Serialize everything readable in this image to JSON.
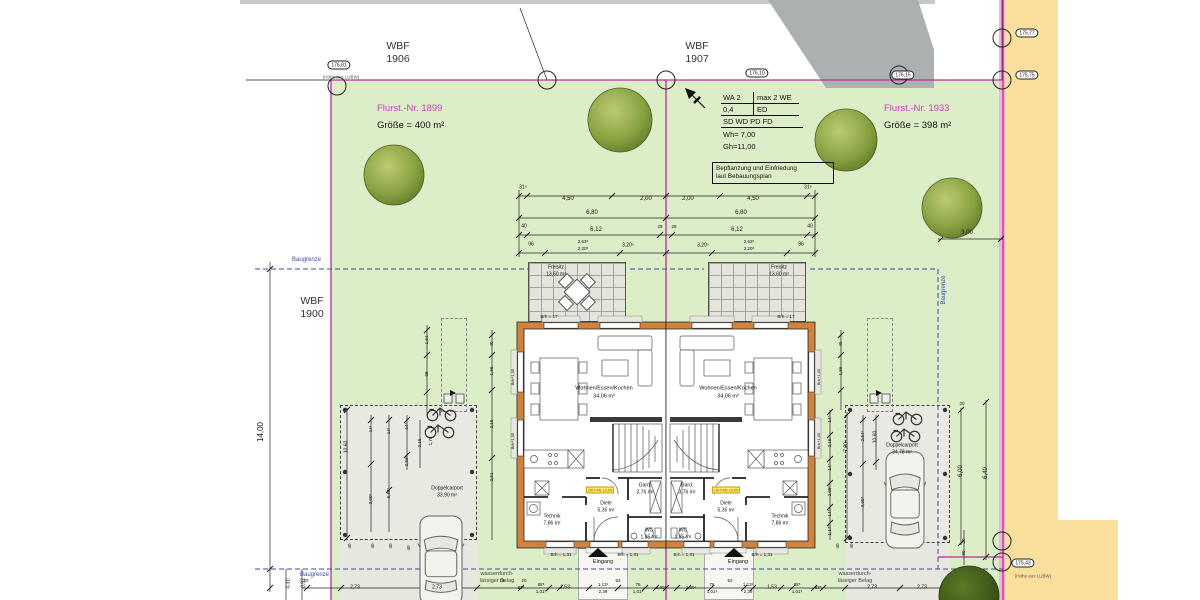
{
  "labels": {
    "wbf_1906": {
      "l1": "WBF",
      "l2": "1906"
    },
    "wbf_1907": {
      "l1": "WBF",
      "l2": "1907"
    },
    "wbf_1900": {
      "l1": "WBF",
      "l2": "1900"
    }
  },
  "parcels": {
    "left": {
      "nr": "Flurst.-Nr. 1899",
      "size": "Größe = 400 m²"
    },
    "right": {
      "nr": "Flurst.-Nr. 1933",
      "size": "Größe = 398 m²"
    }
  },
  "zoning": {
    "r1c1": "WA 2",
    "r1c2": "max 2 WE",
    "r2c1": "0,4",
    "r2c2": "ED",
    "r3": "SD WD PD FD",
    "wh": "Wh= 7,00",
    "gh": "Gh=11,00",
    "note1": "Bepflanzung und Einfriedung",
    "note2": "laut Bebauungsplan"
  },
  "baugrenze": {
    "label": "Baugrenze"
  },
  "paving": {
    "line1": "wasserdurch-",
    "line2": "lässiger Belag"
  },
  "entrance": {
    "label": "Eingang"
  },
  "floor_tag": "OK FFB ±0,00",
  "floor_tags": [
    [
      600,
      490
    ],
    [
      726,
      490
    ]
  ],
  "ovals": [
    [
      339,
      65,
      "176,81"
    ],
    [
      757,
      73,
      "176,10"
    ],
    [
      903,
      75,
      "176,15"
    ],
    [
      1027,
      33,
      "175,77"
    ],
    [
      1027,
      75,
      "175,75"
    ],
    [
      1023,
      563,
      "175,43"
    ]
  ],
  "oval_subs": [
    [
      341,
      77,
      "(Höhe aus LUBW)"
    ],
    [
      1033,
      576,
      "(Höhe aus LUBW)"
    ]
  ],
  "survey_circles": [
    [
      337,
      86
    ],
    [
      547,
      80
    ],
    [
      666,
      80
    ],
    [
      899,
      75
    ],
    [
      1002,
      38
    ],
    [
      1002,
      80
    ],
    [
      1002,
      541
    ],
    [
      1002,
      562
    ]
  ],
  "trees": [
    [
      394,
      175,
      30,
      0
    ],
    [
      620,
      120,
      32,
      0
    ],
    [
      846,
      140,
      31,
      0
    ],
    [
      952,
      208,
      30,
      0
    ],
    [
      969,
      596,
      30,
      1
    ]
  ],
  "colors": {
    "boundary": "#c02aa0",
    "baugrenze": "#3d49a6",
    "lawn": "#dceec7",
    "street": "#fbdf9d",
    "wall": "#d0833e",
    "flurst_text": "#cc3fc0"
  },
  "annotations": [
    [
      523,
      188,
      "31⁵",
      0,
      5
    ],
    [
      808,
      188,
      "31⁵",
      0,
      5
    ],
    [
      568,
      199,
      "4,50",
      0,
      0
    ],
    [
      646,
      199,
      "2,00",
      0,
      0
    ],
    [
      688,
      199,
      "2,00",
      0,
      0
    ],
    [
      753,
      199,
      "4,50",
      0,
      0
    ],
    [
      592,
      213,
      "6,80",
      0,
      0
    ],
    [
      741,
      213,
      "6,80",
      0,
      0
    ],
    [
      524,
      227,
      "40",
      0,
      5
    ],
    [
      810,
      227,
      "40",
      0,
      5
    ],
    [
      596,
      230,
      "6,12",
      0,
      0
    ],
    [
      737,
      230,
      "6,12",
      0,
      0
    ],
    [
      660,
      227,
      "28",
      0,
      4.5
    ],
    [
      674,
      227,
      "28",
      0,
      4.5
    ],
    [
      531,
      245,
      "96",
      0,
      5
    ],
    [
      801,
      245,
      "96",
      0,
      5
    ],
    [
      583,
      242,
      "2,63⁵",
      0,
      4.5
    ],
    [
      583,
      249,
      "2,20⁵",
      0,
      4.5
    ],
    [
      749,
      242,
      "2,63⁵",
      0,
      4.5
    ],
    [
      749,
      249,
      "2,20⁵",
      0,
      4.5
    ],
    [
      628,
      246,
      "3,20⁵",
      0,
      5
    ],
    [
      703,
      246,
      "3,20⁵",
      0,
      5
    ],
    [
      261,
      432,
      "14,00",
      1,
      8
    ],
    [
      289,
      583,
      "4,31¹",
      1,
      5
    ],
    [
      304,
      583,
      "3,92",
      1,
      5
    ],
    [
      967,
      233,
      "3,00",
      0,
      0
    ],
    [
      961,
      471,
      "6,00",
      1,
      6
    ],
    [
      986,
      473,
      "6,40",
      1,
      6
    ],
    [
      962,
      404,
      "20",
      0,
      4.5
    ],
    [
      964,
      541,
      "20",
      1,
      4.5
    ],
    [
      964,
      553,
      "80",
      1,
      4.5
    ],
    [
      347,
      447,
      "10,60",
      1,
      5
    ],
    [
      371,
      429,
      "14¹",
      1,
      4.5
    ],
    [
      371,
      499,
      "3,00⁵",
      1,
      4.5
    ],
    [
      389,
      431,
      "14¹",
      1,
      4.5
    ],
    [
      389,
      493,
      "5,69⁵",
      1,
      4.5
    ],
    [
      407,
      426,
      "14⁵",
      1,
      4.5
    ],
    [
      407,
      461,
      "2,56⁵",
      1,
      4.5
    ],
    [
      420,
      443,
      "2,15",
      1,
      4.5
    ],
    [
      431,
      441,
      "1,78",
      1,
      4.5
    ],
    [
      350,
      546,
      "40",
      1,
      4.5
    ],
    [
      373,
      546,
      "40",
      1,
      4.5
    ],
    [
      391,
      546,
      "40",
      1,
      4.5
    ],
    [
      409,
      548,
      "40",
      1,
      4.5
    ],
    [
      447,
      489,
      "Doppelcarport",
      0,
      5
    ],
    [
      447,
      496,
      "33,90 m²",
      0,
      5
    ],
    [
      830,
      419,
      "14⁵",
      1,
      4.5
    ],
    [
      830,
      443,
      "2,15",
      1,
      4.5
    ],
    [
      830,
      467,
      "14⁵",
      1,
      4.5
    ],
    [
      830,
      491,
      "2,08⁵",
      1,
      4.5
    ],
    [
      830,
      513,
      "14⁵",
      1,
      4.5
    ],
    [
      830,
      530,
      "1,17⁵",
      1,
      4.5
    ],
    [
      847,
      447,
      "7,20",
      1,
      5
    ],
    [
      863,
      436,
      "2,54⁵",
      1,
      4.5
    ],
    [
      863,
      502,
      "3,00⁵",
      1,
      4.5
    ],
    [
      876,
      437,
      "10,60",
      1,
      5
    ],
    [
      838,
      546,
      "40",
      1,
      4.5
    ],
    [
      852,
      546,
      "40",
      1,
      4.5
    ],
    [
      902,
      446,
      "Doppelcarport",
      0,
      5
    ],
    [
      902,
      453,
      "34,78 m²",
      0,
      5
    ],
    [
      427,
      340,
      "1,64",
      1,
      4.5
    ],
    [
      427,
      374,
      "98",
      1,
      4.5
    ],
    [
      492,
      344,
      "40",
      1,
      4.5
    ],
    [
      492,
      371,
      "1,86",
      1,
      4.5
    ],
    [
      492,
      424,
      "2,15",
      1,
      4.5
    ],
    [
      492,
      477,
      "2,51",
      1,
      4.5
    ],
    [
      841,
      344,
      "40",
      1,
      4.5
    ],
    [
      841,
      371,
      "1,86",
      1,
      4.5
    ],
    [
      556,
      268,
      "Freisitz",
      0,
      5
    ],
    [
      556,
      275,
      "13,60 m²",
      0,
      5
    ],
    [
      779,
      268,
      "Freisitz",
      0,
      5
    ],
    [
      779,
      275,
      "13,60 m²",
      0,
      5
    ],
    [
      549,
      317,
      "Brh = 17",
      0,
      4.5
    ],
    [
      786,
      317,
      "Brh = 17",
      0,
      4.5
    ],
    [
      604,
      389,
      "Wohnen/Essen/Kochen",
      0,
      5.5
    ],
    [
      604,
      397,
      "34,06 m²",
      0,
      5.5
    ],
    [
      728,
      389,
      "Wohnen/Essen/Kochen",
      0,
      5.5
    ],
    [
      728,
      397,
      "34,06 m²",
      0,
      5.5
    ],
    [
      645,
      486,
      "Gard.",
      0,
      5
    ],
    [
      645,
      493,
      "3,76 m²",
      0,
      5
    ],
    [
      687,
      486,
      "Gard.",
      0,
      5
    ],
    [
      687,
      493,
      "3,76 m²",
      0,
      5
    ],
    [
      606,
      504,
      "Diele",
      0,
      5
    ],
    [
      606,
      511,
      "5,35 m²",
      0,
      5
    ],
    [
      726,
      504,
      "Diele",
      0,
      5
    ],
    [
      726,
      511,
      "5,35 m²",
      0,
      5
    ],
    [
      552,
      517,
      "Technik",
      0,
      5
    ],
    [
      552,
      524,
      "7,86 m²",
      0,
      5
    ],
    [
      780,
      517,
      "Technik",
      0,
      5
    ],
    [
      780,
      524,
      "7,86 m²",
      0,
      5
    ],
    [
      649,
      531,
      "WC",
      0,
      5
    ],
    [
      649,
      538,
      "1,85 m²",
      0,
      5
    ],
    [
      683,
      531,
      "WC",
      0,
      5
    ],
    [
      683,
      538,
      "1,85 m²",
      0,
      5
    ],
    [
      513,
      377,
      "Brh+1,05",
      1,
      4
    ],
    [
      513,
      441,
      "Brh+1,05",
      1,
      4
    ],
    [
      819,
      377,
      "Brh+1,05",
      1,
      4
    ],
    [
      819,
      441,
      "Brh+1,05",
      1,
      4
    ],
    [
      561,
      555,
      "Brh = 1,31",
      0,
      4.5
    ],
    [
      628,
      555,
      "Brh = 1,31",
      0,
      4.5
    ],
    [
      684,
      555,
      "Brh = 1,31",
      0,
      4.5
    ],
    [
      762,
      555,
      "Brh = 1,31",
      0,
      4.5
    ],
    [
      306,
      581,
      "20",
      0,
      4.5
    ],
    [
      355,
      588,
      "2,73",
      0,
      5
    ],
    [
      437,
      588,
      "2,73",
      0,
      5
    ],
    [
      502,
      581,
      "14",
      0,
      4.5
    ],
    [
      524,
      581,
      "20",
      0,
      4.5
    ],
    [
      521,
      588,
      "87⁵",
      0,
      4.5
    ],
    [
      541,
      585,
      "88⁵",
      0,
      4.5
    ],
    [
      541,
      592,
      "1,01⁵",
      0,
      4.5
    ],
    [
      565,
      588,
      "1,53",
      0,
      5
    ],
    [
      603,
      585,
      "1,13¹",
      0,
      4.5
    ],
    [
      603,
      592,
      "2,39",
      0,
      4.5
    ],
    [
      618,
      581,
      "53",
      0,
      4.5
    ],
    [
      638,
      585,
      "76",
      0,
      4.5
    ],
    [
      638,
      592,
      "1,01⁵",
      0,
      4.5
    ],
    [
      661,
      588,
      "1,09¹",
      0,
      4.5
    ],
    [
      691,
      588,
      "1,09¹",
      0,
      4.5
    ],
    [
      712,
      585,
      "76",
      0,
      4.5
    ],
    [
      712,
      592,
      "1,01⁵",
      0,
      4.5
    ],
    [
      730,
      581,
      "52",
      0,
      4.5
    ],
    [
      748,
      585,
      "1,13¹",
      0,
      4.5
    ],
    [
      748,
      592,
      "2,39",
      0,
      4.5
    ],
    [
      772,
      588,
      "1,53",
      0,
      5
    ],
    [
      797,
      585,
      "88⁵",
      0,
      4.5
    ],
    [
      797,
      592,
      "1,01⁵",
      0,
      4.5
    ],
    [
      818,
      588,
      "87⁵",
      0,
      4.5
    ],
    [
      872,
      588,
      "2,73",
      0,
      5
    ],
    [
      922,
      588,
      "2,73",
      0,
      5
    ]
  ],
  "lines": {
    "mag": [
      [
        331,
        80,
        1003,
        80
      ],
      [
        331,
        80,
        331,
        600
      ],
      [
        1003,
        0,
        1003,
        600
      ],
      [
        666,
        80,
        666,
        600
      ],
      [
        938,
        557,
        1003,
        557
      ]
    ],
    "bgz": [
      [
        255,
        269,
        528,
        269
      ],
      [
        630,
        269,
        704,
        269
      ],
      [
        810,
        269,
        938,
        269
      ],
      [
        938,
        269,
        938,
        569
      ],
      [
        255,
        569,
        1003,
        569
      ]
    ],
    "dim": [
      [
        519,
        196,
        815,
        196
      ],
      [
        519,
        218,
        815,
        218
      ],
      [
        519,
        235,
        815,
        235
      ],
      [
        519,
        253,
        815,
        253
      ],
      [
        519,
        190,
        519,
        257
      ],
      [
        815,
        190,
        815,
        257
      ],
      [
        270,
        262,
        270,
        592
      ],
      [
        246,
        80,
        331,
        80
      ],
      [
        520,
        8,
        547,
        80
      ],
      [
        1002,
        0,
        1002,
        80
      ],
      [
        938,
        239,
        1003,
        239
      ],
      [
        961,
        408,
        961,
        545
      ],
      [
        986,
        400,
        986,
        560
      ],
      [
        302,
        588,
        958,
        588
      ],
      [
        286,
        569,
        286,
        600
      ],
      [
        302,
        569,
        302,
        600
      ],
      [
        347,
        408,
        347,
        540
      ],
      [
        371,
        415,
        371,
        532
      ],
      [
        389,
        415,
        389,
        532
      ],
      [
        407,
        415,
        407,
        470
      ],
      [
        420,
        420,
        420,
        468
      ],
      [
        830,
        410,
        830,
        540
      ],
      [
        847,
        412,
        847,
        540
      ],
      [
        863,
        415,
        863,
        532
      ],
      [
        876,
        415,
        876,
        470
      ],
      [
        427,
        325,
        427,
        415
      ],
      [
        492,
        330,
        492,
        540
      ],
      [
        841,
        330,
        841,
        410
      ],
      [
        964,
        530,
        964,
        565
      ]
    ]
  },
  "slashes": [
    [
      519,
      196
    ],
    [
      527,
      196
    ],
    [
      612,
      196
    ],
    [
      666,
      196
    ],
    [
      720,
      196
    ],
    [
      807,
      196
    ],
    [
      815,
      196
    ],
    [
      519,
      218
    ],
    [
      666,
      218
    ],
    [
      815,
      218
    ],
    [
      519,
      235
    ],
    [
      527,
      235
    ],
    [
      660,
      235
    ],
    [
      672,
      235
    ],
    [
      807,
      235
    ],
    [
      815,
      235
    ],
    [
      519,
      253
    ],
    [
      545,
      253
    ],
    [
      620,
      253
    ],
    [
      666,
      253
    ],
    [
      712,
      253
    ],
    [
      787,
      253
    ],
    [
      815,
      253
    ],
    [
      270,
      269
    ],
    [
      270,
      569
    ],
    [
      270,
      588
    ],
    [
      941,
      239
    ],
    [
      1001,
      239
    ],
    [
      961,
      410
    ],
    [
      961,
      543
    ],
    [
      986,
      402
    ],
    [
      986,
      557
    ],
    [
      307,
      588
    ],
    [
      341,
      588
    ],
    [
      432,
      588
    ],
    [
      477,
      588
    ],
    [
      521,
      588
    ],
    [
      549,
      588
    ],
    [
      560,
      588
    ],
    [
      589,
      588
    ],
    [
      618,
      588
    ],
    [
      645,
      588
    ],
    [
      656,
      588
    ],
    [
      666,
      588
    ],
    [
      677,
      588
    ],
    [
      688,
      588
    ],
    [
      711,
      588
    ],
    [
      744,
      588
    ],
    [
      753,
      588
    ],
    [
      781,
      588
    ],
    [
      792,
      588
    ],
    [
      814,
      588
    ],
    [
      823,
      588
    ],
    [
      845,
      588
    ],
    [
      900,
      588
    ],
    [
      945,
      588
    ],
    [
      347,
      410
    ],
    [
      347,
      538
    ],
    [
      371,
      420
    ],
    [
      371,
      464
    ],
    [
      389,
      420
    ],
    [
      389,
      490
    ],
    [
      407,
      420
    ],
    [
      407,
      455
    ],
    [
      830,
      412
    ],
    [
      830,
      435
    ],
    [
      830,
      459
    ],
    [
      830,
      483
    ],
    [
      830,
      507
    ],
    [
      830,
      523
    ],
    [
      847,
      415
    ],
    [
      847,
      538
    ],
    [
      863,
      420
    ],
    [
      863,
      464
    ],
    [
      876,
      418
    ],
    [
      876,
      462
    ],
    [
      427,
      330
    ],
    [
      427,
      355
    ],
    [
      427,
      392
    ],
    [
      492,
      335
    ],
    [
      492,
      355
    ],
    [
      492,
      390
    ],
    [
      492,
      458
    ],
    [
      841,
      335
    ],
    [
      841,
      355
    ],
    [
      841,
      390
    ]
  ]
}
